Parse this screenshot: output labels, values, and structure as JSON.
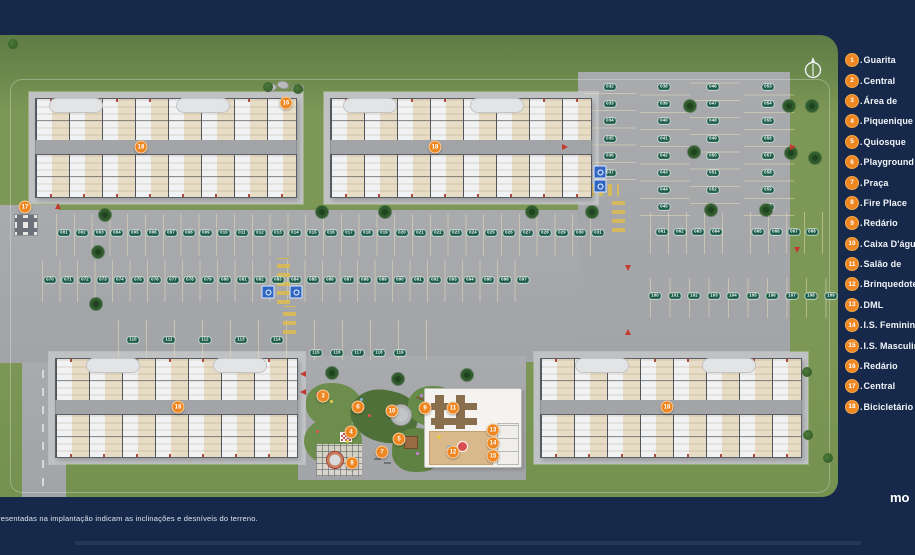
{
  "legend": {
    "separator": ".",
    "items": [
      {
        "n": "1",
        "label": "Guarita"
      },
      {
        "n": "2",
        "label": "Central"
      },
      {
        "n": "3",
        "label": "Área de"
      },
      {
        "n": "4",
        "label": "Piquenique"
      },
      {
        "n": "5",
        "label": "Quiosque"
      },
      {
        "n": "6",
        "label": "Playground"
      },
      {
        "n": "7",
        "label": "Praça"
      },
      {
        "n": "8",
        "label": "Fire Place"
      },
      {
        "n": "9",
        "label": "Redário"
      },
      {
        "n": "10",
        "label": "Caixa D'água"
      },
      {
        "n": "11",
        "label": "Salão de"
      },
      {
        "n": "12",
        "label": "Brinquedoteca"
      },
      {
        "n": "13",
        "label": "DML"
      },
      {
        "n": "14",
        "label": "I.S. Feminino"
      },
      {
        "n": "15",
        "label": "I.S. Masculino"
      },
      {
        "n": "16",
        "label": "Redário"
      },
      {
        "n": "17",
        "label": "Central"
      },
      {
        "n": "18",
        "label": "Bicicletário"
      }
    ]
  },
  "footer": {
    "note": "resentadas na implantação indicam as inclinações e desníveis do terreno.",
    "logo": "mo"
  },
  "plan": {
    "building_badges": [
      {
        "n": "18",
        "x": 141,
        "y": 147
      },
      {
        "n": "18",
        "x": 435,
        "y": 147
      },
      {
        "n": "18",
        "x": 178,
        "y": 407
      },
      {
        "n": "18",
        "x": 667,
        "y": 407
      }
    ],
    "amenity_badges": [
      {
        "n": "16",
        "x": 286,
        "y": 103
      },
      {
        "n": "17",
        "x": 25,
        "y": 207
      },
      {
        "n": "3",
        "x": 323,
        "y": 396
      },
      {
        "n": "6",
        "x": 358,
        "y": 407
      },
      {
        "n": "9",
        "x": 425,
        "y": 408
      },
      {
        "n": "10",
        "x": 392,
        "y": 411
      },
      {
        "n": "4",
        "x": 351,
        "y": 432
      },
      {
        "n": "5",
        "x": 399,
        "y": 439
      },
      {
        "n": "7",
        "x": 382,
        "y": 452
      },
      {
        "n": "8",
        "x": 352,
        "y": 463
      },
      {
        "n": "11",
        "x": 453,
        "y": 408
      },
      {
        "n": "12",
        "x": 453,
        "y": 452
      },
      {
        "n": "13",
        "x": 493,
        "y": 430
      },
      {
        "n": "14",
        "x": 493,
        "y": 443
      },
      {
        "n": "15",
        "x": 493,
        "y": 456
      }
    ],
    "parking_rows": [
      {
        "dir": "h",
        "y": 233,
        "x0": 64,
        "gap": 17.8,
        "labels": [
          "001",
          "002",
          "003",
          "004",
          "005",
          "006",
          "007",
          "008",
          "009",
          "010",
          "011",
          "012",
          "013",
          "014",
          "015",
          "016",
          "017",
          "018",
          "019",
          "020",
          "021",
          "022",
          "023",
          "024",
          "025",
          "026",
          "027",
          "028",
          "029",
          "030",
          "031"
        ]
      },
      {
        "dir": "h",
        "y": 280,
        "x0": 50,
        "gap": 17.5,
        "labels": [
          "070",
          "071",
          "072",
          "073",
          "074",
          "075",
          "076",
          "077",
          "078",
          "079",
          "080",
          "081",
          "082",
          "083",
          "084",
          "085",
          "086",
          "087",
          "088",
          "089",
          "090",
          "091",
          "092",
          "093",
          "094",
          "095",
          "096",
          "097"
        ]
      },
      {
        "dir": "h",
        "y": 296,
        "x0": 655,
        "gap": 19.5,
        "labels": [
          "100",
          "101",
          "102",
          "103",
          "104",
          "105",
          "106",
          "107",
          "108",
          "109"
        ]
      },
      {
        "dir": "h",
        "y": 340,
        "x0": 133,
        "gap": 36,
        "labels": [
          "110",
          "111",
          "112",
          "113",
          "114"
        ]
      },
      {
        "dir": "h",
        "y": 353,
        "x0": 316,
        "gap": 21,
        "labels": [
          "115",
          "116",
          "117",
          "118",
          "119"
        ]
      },
      {
        "dir": "v",
        "x": 610,
        "y0": 87,
        "gap": 17.2,
        "labels": [
          "032",
          "033",
          "034",
          "035",
          "036",
          "037"
        ]
      },
      {
        "dir": "v",
        "x": 664,
        "y0": 87,
        "gap": 17.2,
        "labels": [
          "038",
          "039",
          "040",
          "041",
          "042",
          "043",
          "044",
          "045"
        ]
      },
      {
        "dir": "v",
        "x": 713,
        "y0": 87,
        "gap": 17.2,
        "labels": [
          "046",
          "047",
          "048",
          "049",
          "050",
          "051",
          "052"
        ]
      },
      {
        "dir": "v",
        "x": 768,
        "y0": 87,
        "gap": 17.2,
        "labels": [
          "053",
          "054",
          "055",
          "056",
          "057",
          "058",
          "059",
          "060"
        ]
      },
      {
        "dir": "h",
        "y": 232,
        "x0": 662,
        "gap": 18,
        "labels": [
          "061",
          "062",
          "063",
          "064"
        ]
      },
      {
        "dir": "h",
        "y": 232,
        "x0": 758,
        "gap": 18,
        "labels": [
          "065",
          "066",
          "067",
          "068"
        ]
      }
    ],
    "accessible_spots": [
      {
        "x": 268,
        "y": 292
      },
      {
        "x": 296,
        "y": 292
      },
      {
        "x": 600,
        "y": 172
      },
      {
        "x": 600,
        "y": 186
      }
    ],
    "trees": {
      "palms": [
        [
          105,
          215
        ],
        [
          322,
          212
        ],
        [
          385,
          212
        ],
        [
          532,
          212
        ],
        [
          592,
          212
        ],
        [
          690,
          106
        ],
        [
          694,
          152
        ],
        [
          789,
          106
        ],
        [
          791,
          153
        ],
        [
          711,
          210
        ],
        [
          766,
          210
        ],
        [
          812,
          106
        ],
        [
          815,
          158
        ],
        [
          98,
          252
        ],
        [
          96,
          304
        ],
        [
          332,
          373
        ],
        [
          398,
          379
        ],
        [
          467,
          375
        ]
      ],
      "bushes": [
        [
          13,
          44
        ],
        [
          268,
          87
        ],
        [
          298,
          89
        ],
        [
          807,
          372
        ],
        [
          808,
          435
        ],
        [
          828,
          458
        ]
      ]
    },
    "slope_arrows": [
      [
        303,
        374,
        270
      ],
      [
        303,
        392,
        270
      ],
      [
        565,
        147,
        90
      ],
      [
        793,
        147,
        90
      ],
      [
        797,
        250,
        180
      ],
      [
        628,
        268,
        180
      ],
      [
        58,
        206,
        0
      ],
      [
        628,
        332,
        0
      ]
    ],
    "flowers": [
      [
        316,
        392
      ],
      [
        330,
        400
      ],
      [
        360,
        398
      ],
      [
        420,
        394
      ],
      [
        316,
        430
      ],
      [
        346,
        440
      ],
      [
        402,
        440
      ],
      [
        416,
        452
      ],
      [
        368,
        414
      ]
    ]
  },
  "colors": {
    "background_navy": "#16294b",
    "grass": "#7d9756",
    "asphalt": "#a6a8ab",
    "badge_orange": "#ee8722",
    "plate_green": "#1c5c49",
    "accessible_blue": "#2f66c4",
    "legend_text": "#f2f5f8"
  }
}
